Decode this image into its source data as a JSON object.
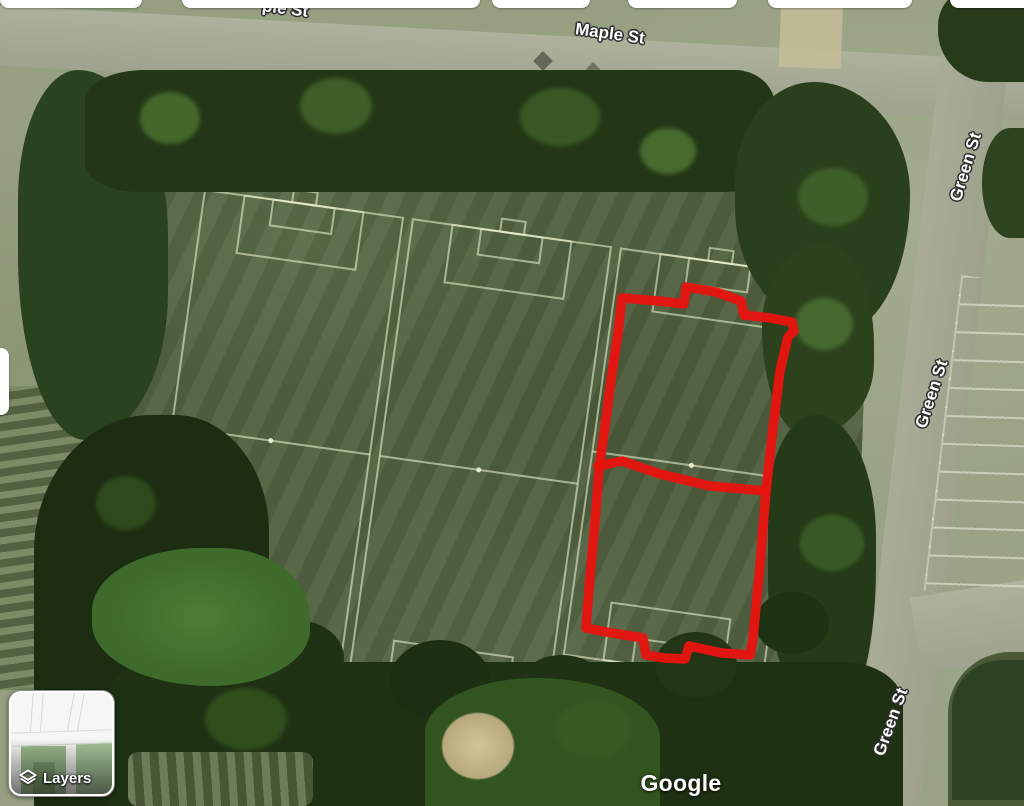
{
  "map": {
    "watermark": "Google",
    "labels": {
      "maple_st": "Maple St",
      "maple_st_partial": "ple St",
      "green_st_top": "Green St",
      "green_st_mid": "Green St",
      "green_st_bottom": "Green St"
    },
    "annotation": {
      "color": "#e81410",
      "shape": "hand-drawn red outline around rightmost soccer field with midline and goal notches"
    },
    "features": {
      "soccer_fields": 3,
      "field_line_color": "#e6ecc8"
    }
  },
  "controls": {
    "layers_button": {
      "label": "Layers",
      "icon": "layers-icon"
    }
  },
  "colors": {
    "annotation_red": "#e81410",
    "playfield_grass": "#51613f",
    "surrounding_grass": "#96a081",
    "road": "#a6aa95",
    "trees": "#22361a",
    "label_text": "#ffffff"
  }
}
